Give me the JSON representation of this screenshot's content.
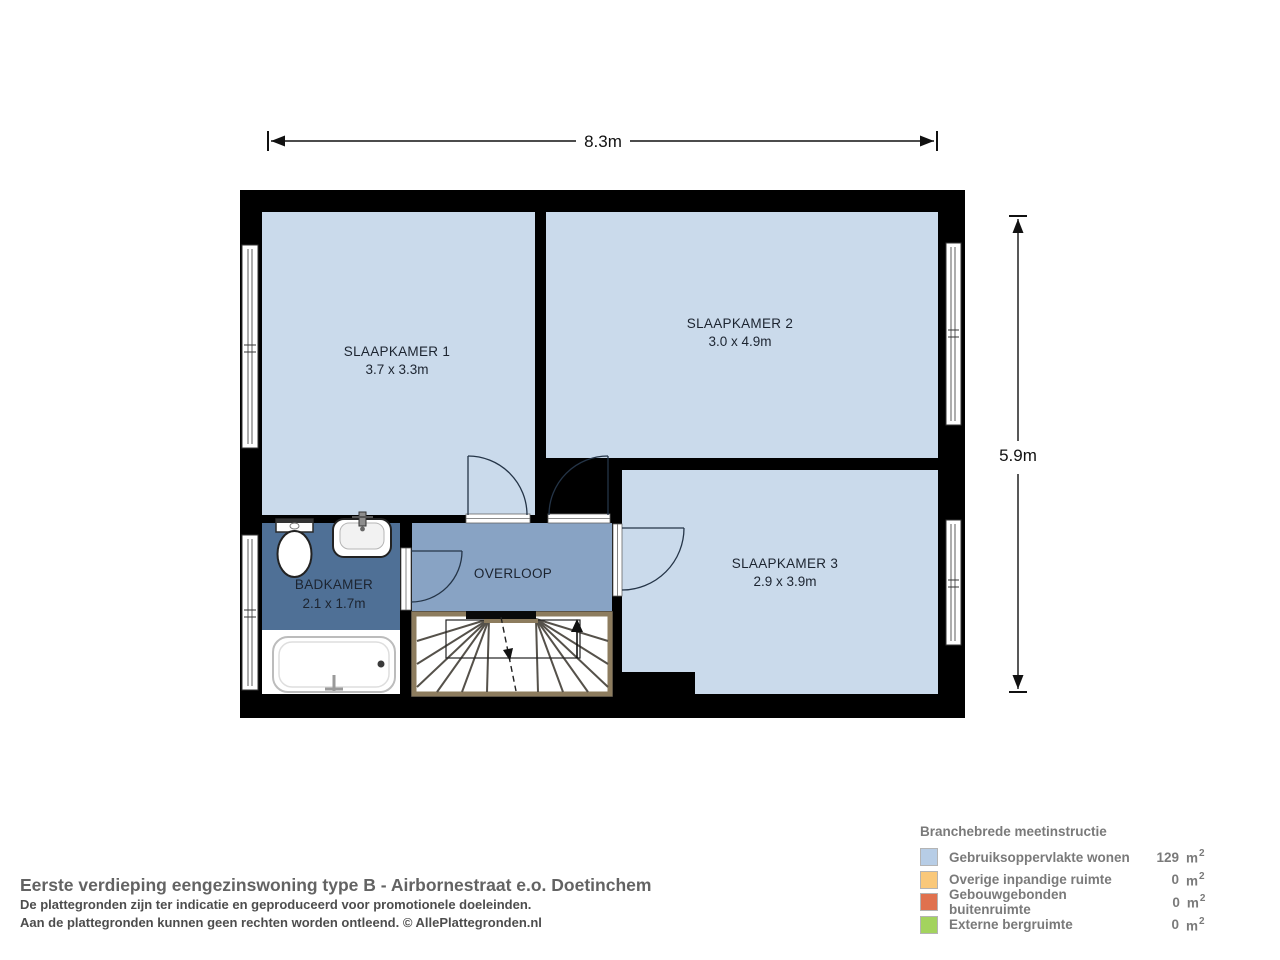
{
  "plan": {
    "dim_width_label": "8.3m",
    "dim_height_label": "5.9m",
    "rooms": [
      {
        "name": "SLAAPKAMER 1",
        "size": "3.7 x 3.3m"
      },
      {
        "name": "SLAAPKAMER 2",
        "size": "3.0 x 4.9m"
      },
      {
        "name": "SLAAPKAMER 3",
        "size": "2.9 x 3.9m"
      },
      {
        "name": "BADKAMER",
        "size": "2.1 x 1.7m"
      },
      {
        "name": "OVERLOOP",
        "size": ""
      }
    ],
    "colors": {
      "room_fill": "#cadaeb",
      "hall_fill": "#88a3c4",
      "bath_fill": "#4f7096",
      "wall": "#000000",
      "stair_border": "#8d7c5e"
    }
  },
  "legend": {
    "title": "Branchebrede meetinstructie",
    "items": [
      {
        "label": "Gebruiksoppervlakte wonen",
        "value": "129",
        "unit": "m",
        "sup": "2",
        "color": "#b7cde6"
      },
      {
        "label": "Overige inpandige ruimte",
        "value": "0",
        "unit": "m",
        "sup": "2",
        "color": "#f9c87a"
      },
      {
        "label": "Gebouwgebonden buitenruimte",
        "value": "0",
        "unit": "m",
        "sup": "2",
        "color": "#e0714e"
      },
      {
        "label": "Externe bergruimte",
        "value": "0",
        "unit": "m",
        "sup": "2",
        "color": "#a3d35e"
      }
    ]
  },
  "footer": {
    "title": "Eerste verdieping eengezinswoning type B - Airbornestraat e.o. Doetinchem",
    "line1": "De plattegronden zijn ter indicatie en geproduceerd voor promotionele doeleinden.",
    "line2": "Aan de plattegronden kunnen geen rechten worden ontleend. © AllePlattegronden.nl"
  }
}
